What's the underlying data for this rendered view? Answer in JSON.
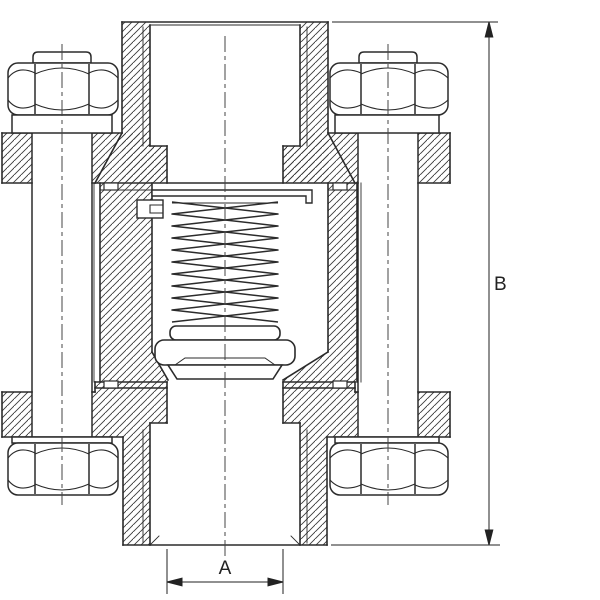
{
  "drawing": {
    "description": "Cross-section engineering drawing of a spring-loaded in-line check valve with three-piece bolted body, threaded top and bottom ports",
    "background_color": "#ffffff",
    "line_color": "#2b2b2b",
    "hatch_color": "#3a3a3a",
    "dimension_labels": {
      "width": "A",
      "height": "B"
    },
    "components": [
      "top-threaded-port",
      "bonnet-cap",
      "top-flange",
      "clamp-bolt-left",
      "clamp-bolt-right",
      "stud-end-left",
      "stud-end-right",
      "hex-nut-top-left",
      "hex-nut-top-right",
      "washer-top-left",
      "washer-top-right",
      "valve-body-center",
      "spring-chamber",
      "compression-spring",
      "spring-retainer",
      "retaining-clip",
      "spring-seat-washer",
      "poppet-disc",
      "seat-seal",
      "outlet-throat",
      "bottom-flange",
      "bottom-port-boss",
      "bottom-threaded-port",
      "hex-nut-bottom-left",
      "hex-nut-bottom-right",
      "washer-bottom-left",
      "washer-bottom-right",
      "gasket-tabs",
      "centerlines",
      "dimension-A-width",
      "dimension-B-height"
    ]
  }
}
